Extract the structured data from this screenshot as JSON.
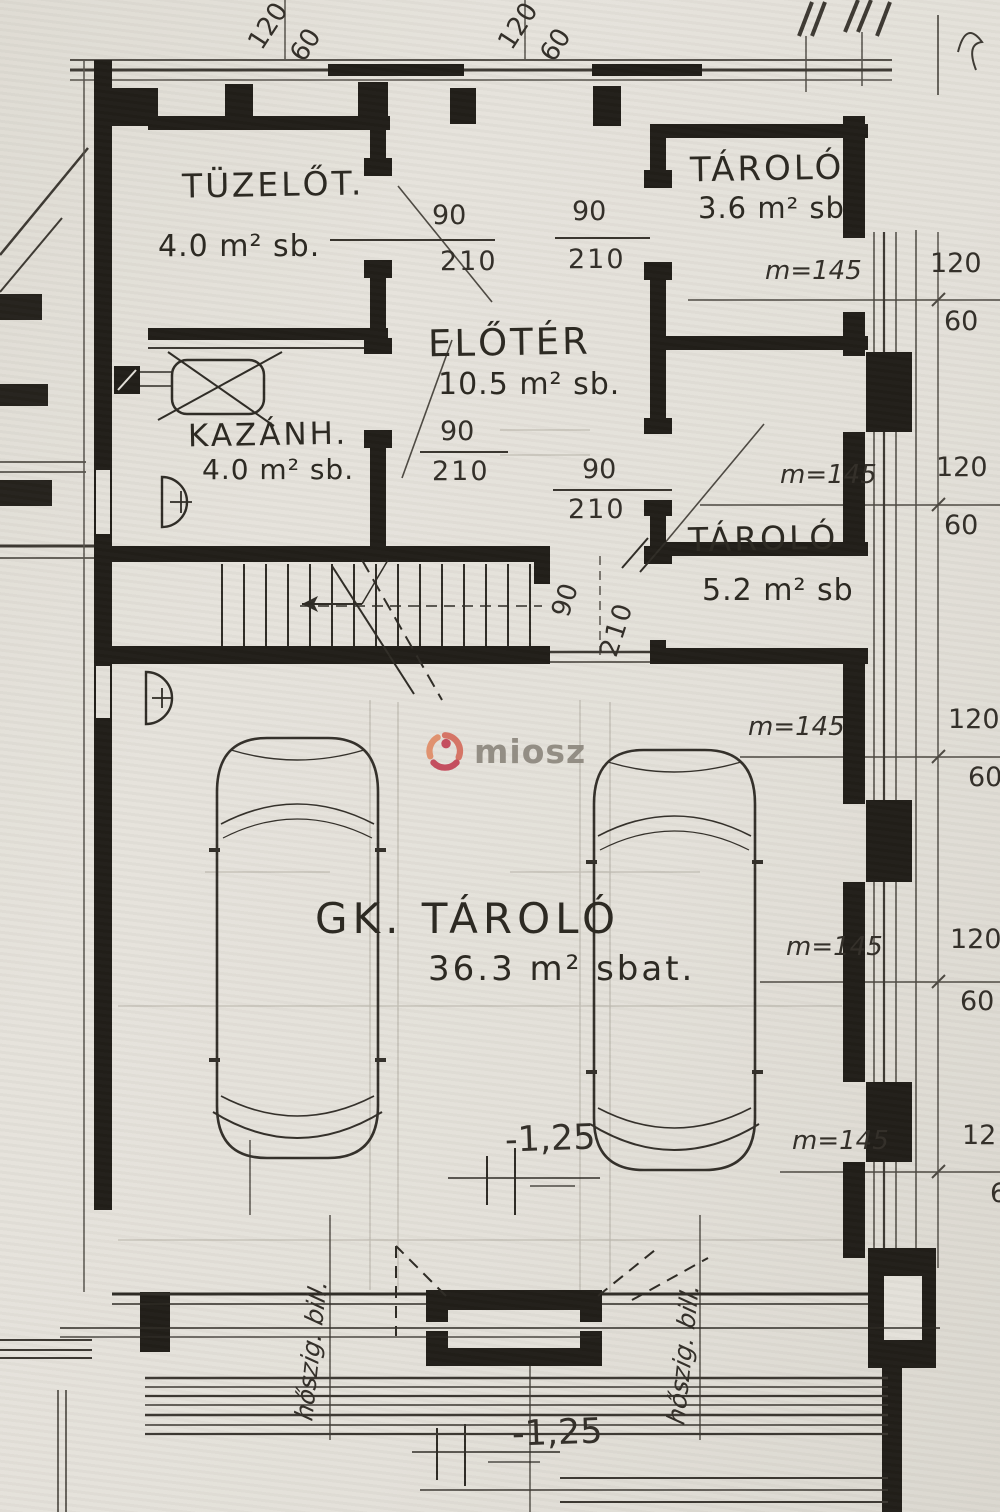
{
  "watermark": {
    "text": "miosz"
  },
  "rooms": {
    "tuzelot": {
      "name": "TÜZELŐT.",
      "area": "4.0 m² sb."
    },
    "tarolo_top": {
      "name": "TÁROLÓ",
      "area": "3.6 m² sb"
    },
    "eloter": {
      "name": "ELŐTÉR",
      "area": "10.5 m² sb."
    },
    "kazanh": {
      "name": "KAZÁNH.",
      "area": "4.0 m² sb."
    },
    "tarolo_mid": {
      "name": "TÁROLÓ",
      "area": "5.2 m² sb"
    },
    "garage": {
      "name": "GK. TÁROLÓ",
      "area": "36.3 m² sbat."
    }
  },
  "door_dim": {
    "width": "90",
    "height": "210"
  },
  "right_dims": [
    {
      "marker": "m=145",
      "num": "120",
      "den": "60"
    },
    {
      "marker": "m=145",
      "num": "120",
      "den": "60"
    },
    {
      "marker": "m=145",
      "num": "120",
      "den": "60"
    },
    {
      "marker": "m=145",
      "num": "120",
      "den": "60"
    },
    {
      "marker": "m=145",
      "num": "12",
      "den": "60"
    }
  ],
  "top_dims": [
    {
      "num": "120",
      "den": "60"
    },
    {
      "num": "120",
      "den": "60"
    }
  ],
  "levels": {
    "upper": "-1,25",
    "lower": "-1,25"
  },
  "notes": {
    "left": "hőszig. bill.",
    "right": "hőszig. bill."
  }
}
